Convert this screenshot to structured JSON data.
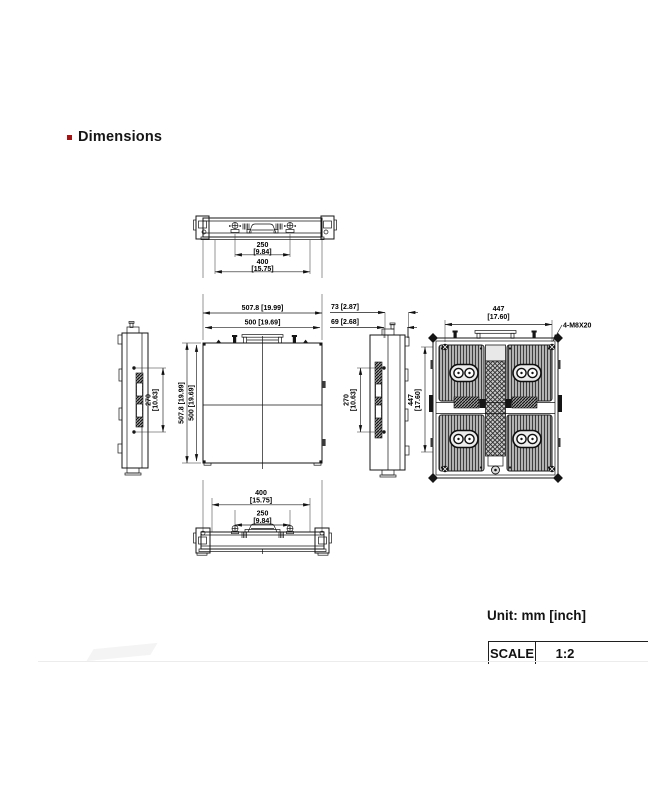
{
  "page": {
    "heading": "Dimensions",
    "unit_note": "Unit: mm [inch]",
    "scale_label": "SCALE",
    "scale_value": "1:2",
    "bullet_color": "#a01616",
    "line_color": "#151515"
  },
  "views": {
    "top": {
      "d250_mm": "250",
      "d250_in": "[9.84]",
      "d400_mm": "400",
      "d400_in": "[15.75]"
    },
    "front": {
      "w_outer": "507.8  [19.99]",
      "w_inner": "500  [19.69]",
      "h_outer": "507.8  [19.99]",
      "h_inner": "500  [19.69]"
    },
    "left": {
      "d270_mm": "270",
      "d270_in": "[10.63]"
    },
    "right": {
      "d73": "73  [2.87]",
      "d69": "69  [2.68]",
      "d270_mm": "270",
      "d270_in": "[10.63]"
    },
    "rear": {
      "w447_mm": "447",
      "w447_in": "[17.60]",
      "h447_mm": "447",
      "h447_in": "[17.60]",
      "bolt_callout": "4-M8X20"
    },
    "bottom": {
      "d400_mm": "400",
      "d400_in": "[15.75]",
      "d250_mm": "250",
      "d250_in": "[9.84]"
    }
  }
}
